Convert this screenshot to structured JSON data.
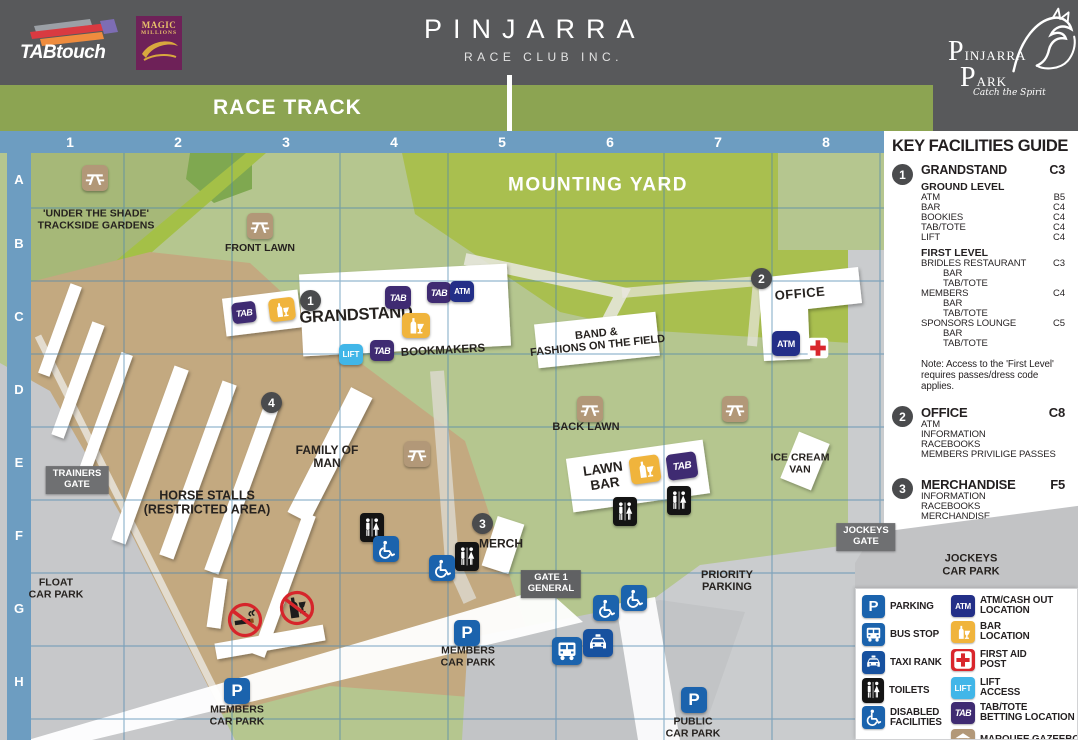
{
  "colors": {
    "header_grey": "#58595b",
    "banner_green": "#8ca452",
    "map_green": "#b5c68f",
    "mounting_yard_green": "#a9bf4f",
    "tan": "#c3a980",
    "ruler_blue": "#6d9dc1",
    "tab_purple": "#3f2b72",
    "atm_navy": "#232f88",
    "lift_blue": "#41b6e8",
    "bar_gold": "#f0b43c",
    "first_aid_red": "#d9262c",
    "parking_blue": "#1b63ad"
  },
  "header": {
    "tabtouch": "TABtouch",
    "magic_line1": "MAGIC",
    "magic_line2": "MILLIONS",
    "title": "PINJARRA",
    "subtitle": "RACE CLUB INC.",
    "park": {
      "line1": "PINJARRA",
      "line2": "PARK",
      "tagline": "Catch the Spirit"
    }
  },
  "banner": {
    "label": "RACE TRACK"
  },
  "grid": {
    "columns": [
      "1",
      "2",
      "3",
      "4",
      "5",
      "6",
      "7",
      "8"
    ],
    "rows": [
      "A",
      "B",
      "C",
      "D",
      "E",
      "F",
      "G",
      "H"
    ]
  },
  "map": {
    "labels": {
      "under_the_shade": [
        "'UNDER THE SHADE'",
        "TRACKSIDE GARDENS"
      ],
      "front_lawn": "FRONT LAWN",
      "mounting_yard": "MOUNTING YARD",
      "grandstand": "GRANDSTAND",
      "bookmakers": "BOOKMAKERS",
      "band_fashions": [
        "BAND &",
        "FASHIONS ON THE FIELD"
      ],
      "office": "OFFICE",
      "back_lawn": "BACK LAWN",
      "lawn_bar": [
        "LAWN",
        "BAR"
      ],
      "ice_cream_van": [
        "ICE CREAM",
        "VAN"
      ],
      "family_of_man": [
        "FAMILY OF",
        "MAN"
      ],
      "horse_stalls": [
        "HORSE STALLS",
        "(RESTRICTED AREA)"
      ],
      "merch": "MERCH",
      "float_car_park": [
        "FLOAT",
        "CAR PARK"
      ],
      "priority_parking": [
        "PRIORITY",
        "PARKING"
      ],
      "members_car_park": [
        "MEMBERS",
        "CAR PARK"
      ],
      "public_car_park": [
        "PUBLIC",
        "CAR PARK"
      ],
      "jockeys_car_park": [
        "JOCKEYS",
        "CAR PARK"
      ]
    },
    "gates": {
      "trainers": [
        "TRAINERS",
        "GATE"
      ],
      "gate1": [
        "GATE 1",
        "GENERAL"
      ],
      "jockeys": [
        "JOCKEYS",
        "GATE"
      ]
    },
    "badges": {
      "b1": "1",
      "b2": "2",
      "b3": "3",
      "b4": "4"
    },
    "markers": {
      "tab": "TAB",
      "atm": "ATM",
      "lift": "LIFT",
      "parking": "P"
    }
  },
  "panel": {
    "title": "KEY FACILITIES GUIDE",
    "grandstand": {
      "num": "1",
      "name": "GRANDSTAND",
      "ref": "C3",
      "ground_heading": "GROUND LEVEL",
      "ground_rows": [
        [
          "ATM",
          "B5"
        ],
        [
          "BAR",
          "C4"
        ],
        [
          "BOOKIES",
          "C4"
        ],
        [
          "TAB/TOTE",
          "C4"
        ],
        [
          "LIFT",
          "C4"
        ]
      ],
      "first_heading": "FIRST LEVEL",
      "first_rows": [
        [
          "BRIDLES RESTAURANT",
          "C3"
        ],
        [
          "BAR",
          ""
        ],
        [
          "TAB/TOTE",
          ""
        ],
        [
          "MEMBERS",
          "C4"
        ],
        [
          "BAR",
          ""
        ],
        [
          "TAB/TOTE",
          ""
        ],
        [
          "SPONSORS LOUNGE",
          "C5"
        ],
        [
          "BAR",
          ""
        ],
        [
          "TAB/TOTE",
          ""
        ]
      ],
      "note": [
        "Note: Access to the 'First Level'",
        "requires passes/dress code",
        "applies."
      ]
    },
    "office": {
      "num": "2",
      "name": "OFFICE",
      "ref": "C8",
      "lines": [
        "ATM",
        "INFORMATION",
        "RACEBOOKS",
        "MEMBERS PRIVILIGE PASSES"
      ]
    },
    "merchandise": {
      "num": "3",
      "name": "MERCHANDISE",
      "ref": "F5",
      "lines": [
        "INFORMATION",
        "RACEBOOKS",
        "MERCHANDISE"
      ]
    },
    "family": {
      "num": "4",
      "name": "FAMILY OF MAN",
      "ref": "D3",
      "lines": [
        "RESTAURANT",
        "TAKE-AWAY"
      ]
    }
  },
  "legend": {
    "left": [
      {
        "name": "parking",
        "label": [
          "PARKING"
        ]
      },
      {
        "name": "bus-stop",
        "label": [
          "BUS STOP"
        ]
      },
      {
        "name": "taxi-rank",
        "label": [
          "TAXI RANK"
        ]
      },
      {
        "name": "toilets",
        "label": [
          "TOILETS"
        ]
      },
      {
        "name": "disabled",
        "label": [
          "DISABLED",
          "FACILITIES"
        ]
      }
    ],
    "right": [
      {
        "name": "atm",
        "label": [
          "ATM/CASH OUT",
          "LOCATION"
        ]
      },
      {
        "name": "bar",
        "label": [
          "BAR",
          "LOCATION"
        ]
      },
      {
        "name": "first-aid",
        "label": [
          "FIRST AID",
          "POST"
        ]
      },
      {
        "name": "lift",
        "label": [
          "LIFT",
          "ACCESS"
        ]
      },
      {
        "name": "tab-tote",
        "label": [
          "TAB/TOTE",
          "BETTING LOCATION"
        ]
      },
      {
        "name": "marquee",
        "label": [
          "MARQUEE.GAZEEBO"
        ]
      }
    ]
  }
}
